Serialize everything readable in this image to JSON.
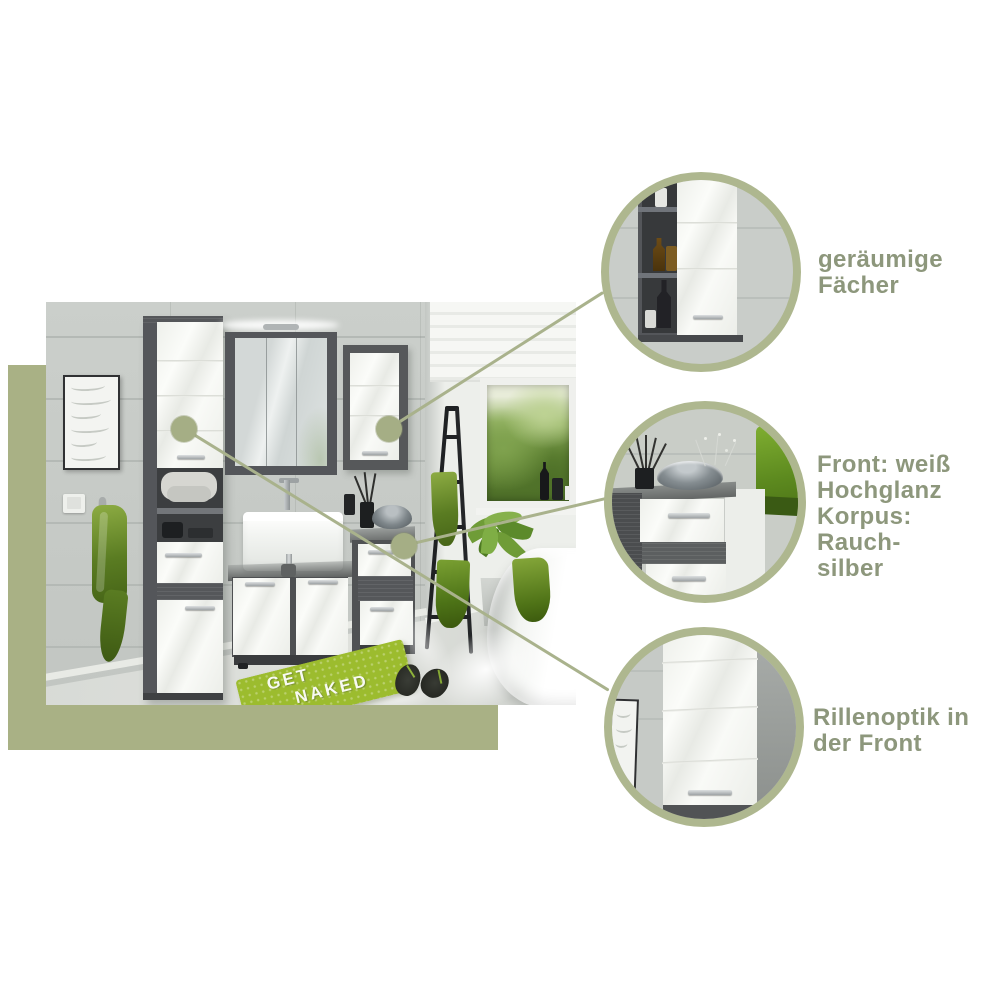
{
  "colors": {
    "sage_panel": "#a9b185",
    "circle_ring": "#aeb78f",
    "connector_line": "#a9b28c",
    "label_text": "#8d977c",
    "towel_green": "#6f9526",
    "mat_green": "#9cbc2e",
    "furniture_body_rauchsilber": "#55575a",
    "furniture_front_white": "#f5f6f3",
    "wall_tile": "#c9cdc9",
    "floor": "#d6d9d5"
  },
  "photo": {
    "mat": {
      "line1": "GET",
      "line2": "NAKED"
    }
  },
  "callouts": [
    {
      "name": "geraeumige-faecher",
      "lines": [
        "geräumige",
        "Fächer"
      ]
    },
    {
      "name": "front-material",
      "lines": [
        "Front: weiß",
        "Hochglanz",
        "Korpus: Rauch-",
        "silber"
      ]
    },
    {
      "name": "rillenoptik",
      "lines": [
        "Rillenoptik in",
        "der Front"
      ]
    }
  ]
}
